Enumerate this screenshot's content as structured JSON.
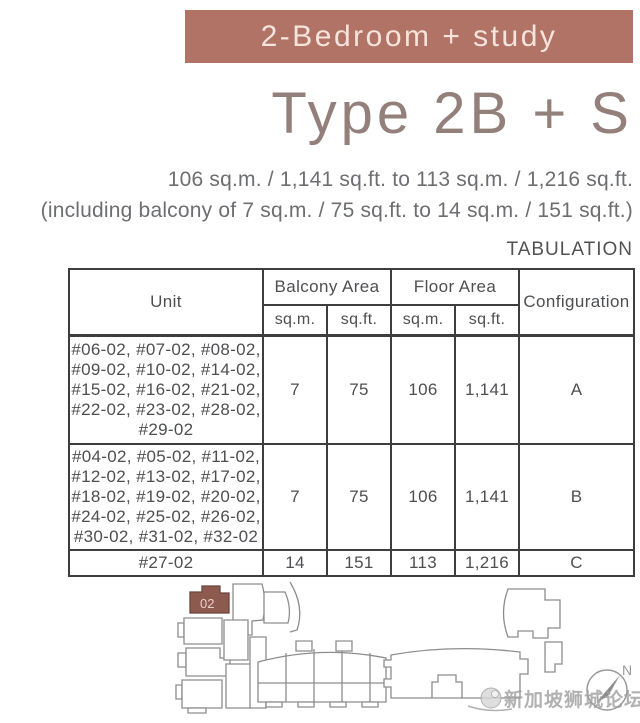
{
  "header": {
    "banner": "2-Bedroom + study",
    "type_title": "Type 2B + S",
    "area_line": "106 sq.m. / 1,141 sq.ft. to 113 sq.m. / 1,216 sq.ft.",
    "balcony_line": "(including balcony of 7 sq.m. / 75 sq.ft. to 14 sq.m. / 151 sq.ft.)"
  },
  "table": {
    "title": "TABULATION",
    "headers": {
      "unit": "Unit",
      "balcony_area": "Balcony Area",
      "floor_area": "Floor Area",
      "configuration": "Configuration",
      "sqm": "sq.m.",
      "sqft": "sq.ft."
    },
    "rows": [
      {
        "units": "#06-02, #07-02, #08-02,\n#09-02, #10-02, #14-02,\n#15-02, #16-02, #21-02,\n#22-02, #23-02, #28-02,\n#29-02",
        "balcony_sqm": "7",
        "balcony_sqft": "75",
        "floor_sqm": "106",
        "floor_sqft": "1,141",
        "configuration": "A"
      },
      {
        "units": "#04-02, #05-02, #11-02,\n#12-02, #13-02, #17-02,\n#18-02, #19-02, #20-02,\n#24-02, #25-02, #26-02,\n#30-02, #31-02, #32-02",
        "balcony_sqm": "7",
        "balcony_sqft": "75",
        "floor_sqm": "106",
        "floor_sqft": "1,141",
        "configuration": "B"
      },
      {
        "units": "#27-02",
        "balcony_sqm": "14",
        "balcony_sqft": "151",
        "floor_sqm": "113",
        "floor_sqft": "1,216",
        "configuration": "C"
      }
    ]
  },
  "siteplan": {
    "highlight_label": "02",
    "compass_label": "N",
    "watermark": "新加坡狮城论坛"
  },
  "colors": {
    "banner_bg": "#b07365",
    "banner_text": "#f6e3dc",
    "type_title": "#93807b",
    "subtitle_text": "#6d6e71",
    "table_border": "#3e3e40",
    "table_text": "#4e4f52",
    "highlight_unit_fill": "#8d5a50",
    "plan_line": "#8d8d8d",
    "watermark_gray": "#9e9e9e"
  }
}
